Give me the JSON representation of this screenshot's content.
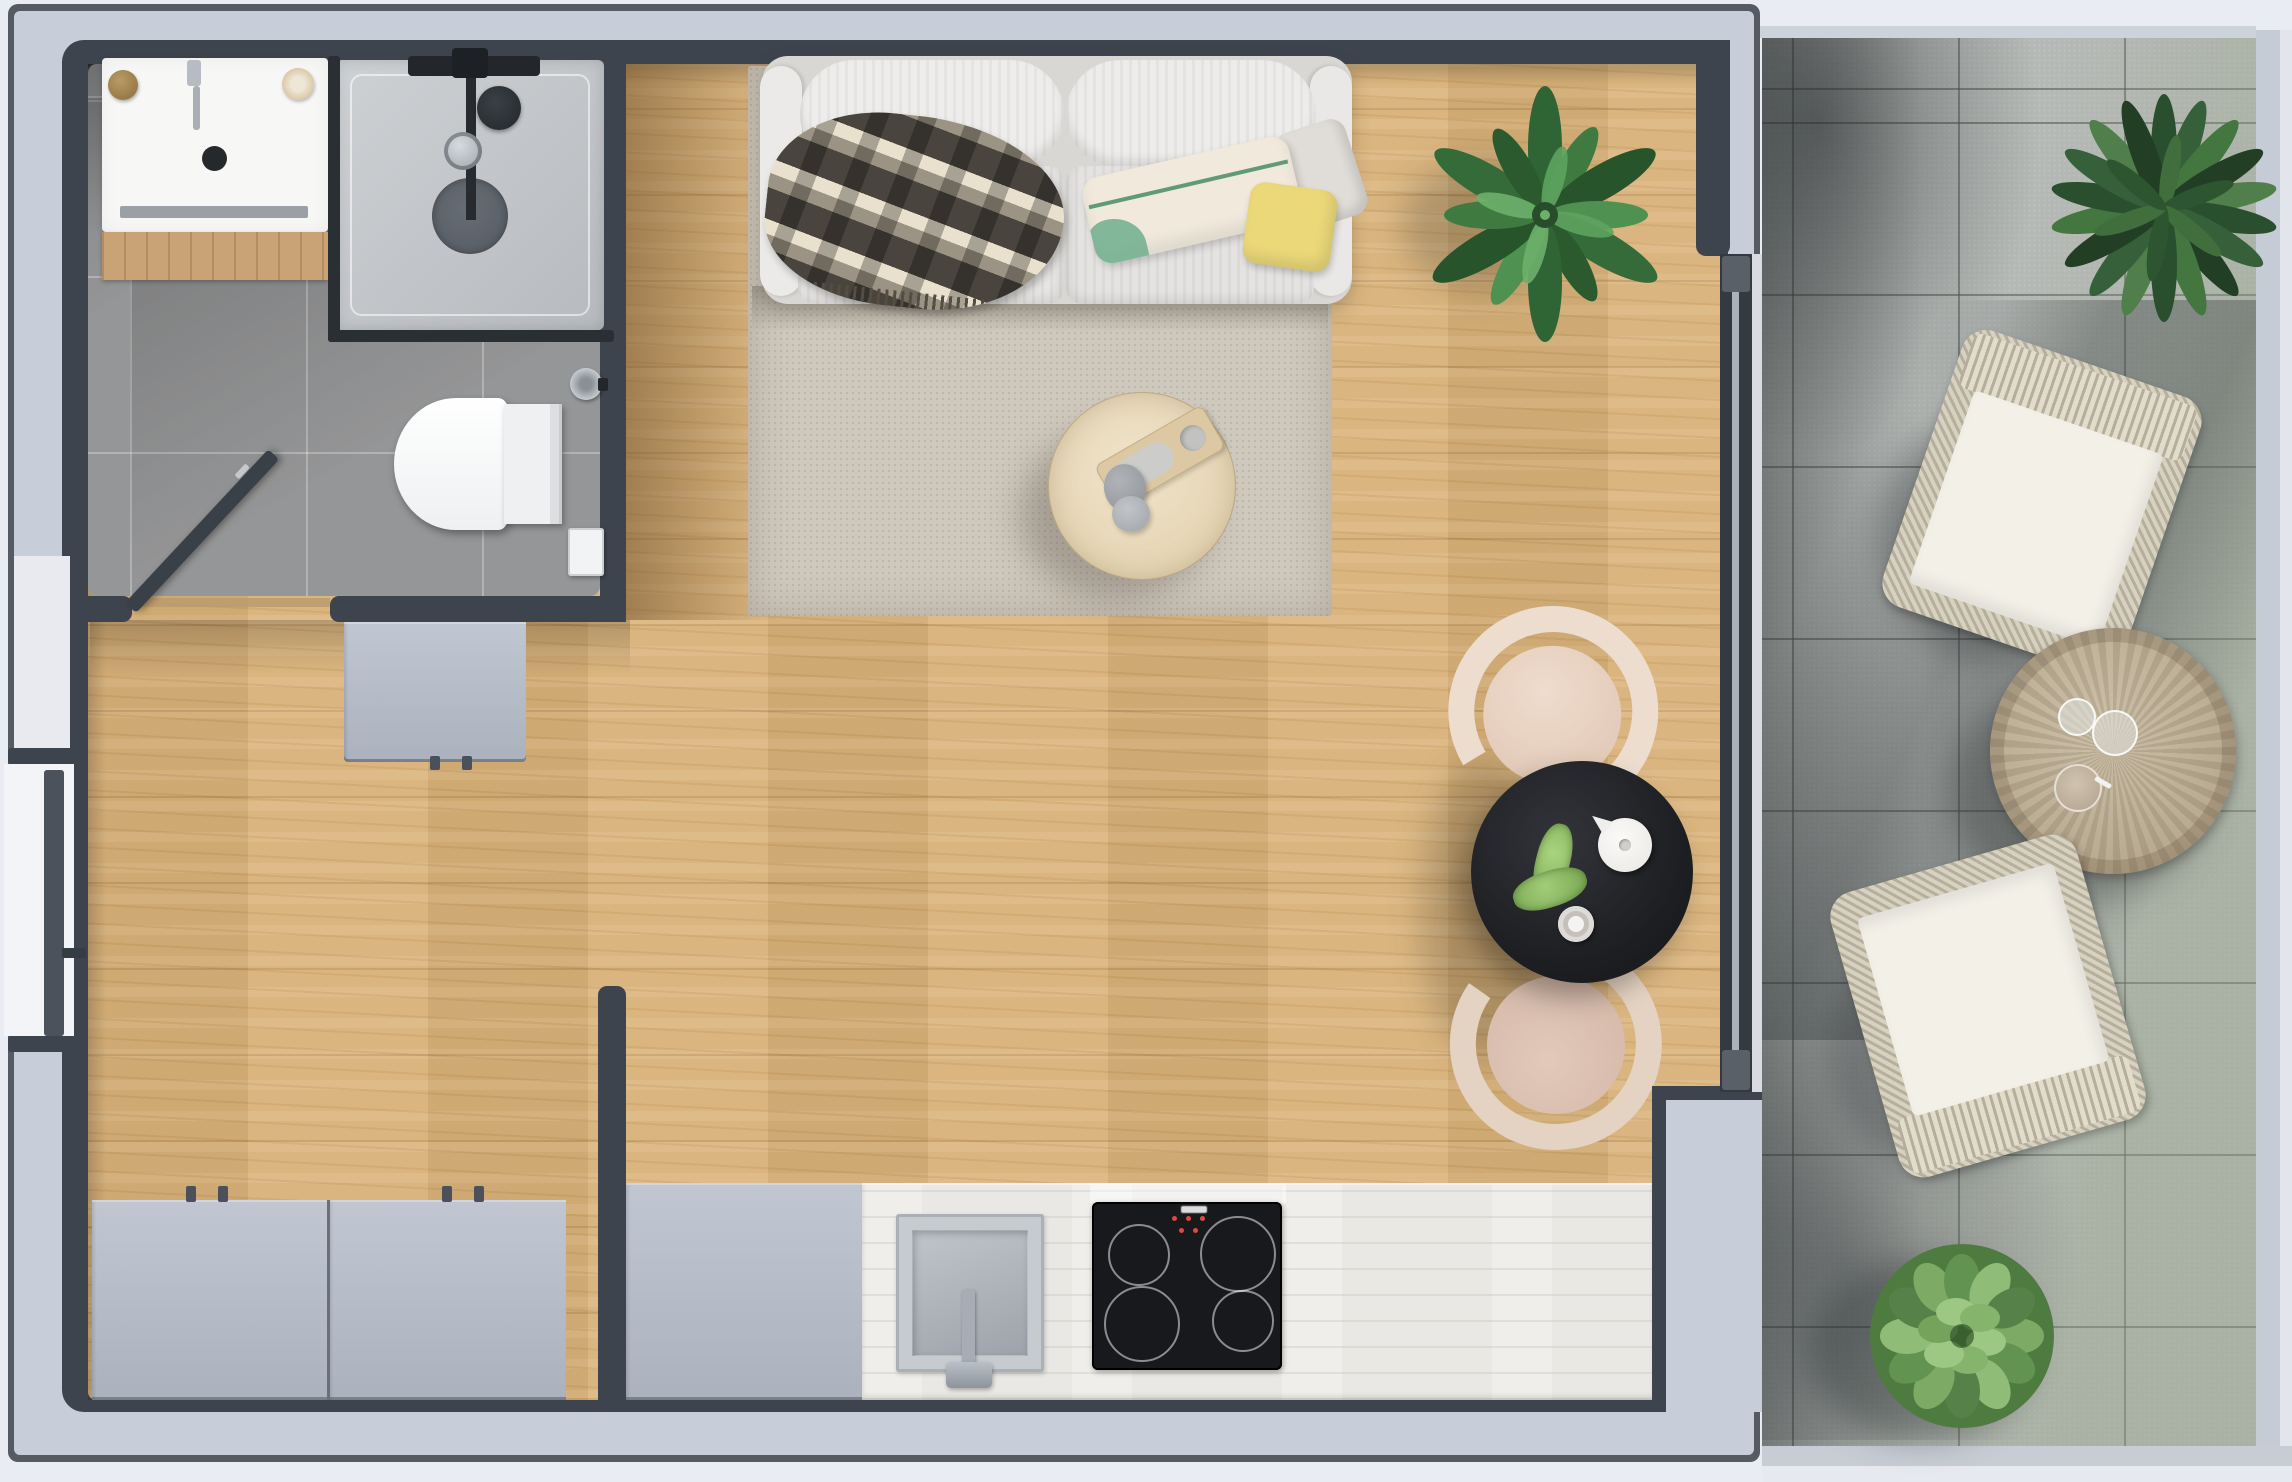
{
  "meta": {
    "kind": "architectural-floor-plan-3d-render",
    "view": "top-down",
    "width_px": 2292,
    "height_px": 1482
  },
  "palette": {
    "outside": "#e9ecf2",
    "wall_outer": "#555a63",
    "wall_light": "#c8ced9",
    "wall_dark": "#3e444d",
    "wood": "#d8b178",
    "bath_tile": "#8e8f90",
    "shower_tray": "#c6c9cd",
    "rug": "#cfc8bc",
    "cabinet": "#b7bdc8",
    "counter": "#eae8e4",
    "cooktop": "#17191d",
    "sofa": "#eceae8",
    "chair_cream": "#ecddcf",
    "table_black": "#202226",
    "balcony_tile": "#b5b9b6",
    "wicker": "#d7d1c0",
    "cushion": "#f3f0e8",
    "plant_dark": "#2f6434",
    "plant_light": "#7dab66",
    "pillow_yellow": "#ead879",
    "mat_wood": "#c9a276",
    "white": "#f7f7f6"
  },
  "rooms": {
    "bathroom": {
      "floor": "grey-stone-tile",
      "items": [
        "washbasin",
        "basin-faucet",
        "soap-dispenser",
        "towel-roll",
        "shelf-bar",
        "wooden-bath-mat",
        "walk-in-shower",
        "shower-fixtures",
        "shower-head",
        "shower-valve",
        "shower-drain",
        "wall-hung-toilet",
        "toilet-brush",
        "toilet-paper-holder",
        "open-bathroom-door"
      ]
    },
    "hallway": {
      "floor": "oak-plank",
      "items": [
        "entrance-door",
        "entrance-door-handle",
        "sideboard-cabinet",
        "wardrobe-left-panel",
        "wardrobe-right-panel"
      ]
    },
    "living_room": {
      "floor": "oak-plank",
      "items": [
        "sofa",
        "sofa-back-cushions",
        "sofa-seat-cushions",
        "plaid-blanket",
        "pillow-cream-green-stripe",
        "pillow-grey",
        "pillow-yellow",
        "area-rug",
        "round-coffee-table",
        "wooden-tray",
        "decor-stones",
        "potted-plant",
        "black-dining-table",
        "dining-chair-north",
        "dining-chair-south",
        "teapot",
        "coffee-cup",
        "green-garnish"
      ]
    },
    "kitchenette": {
      "floor": "oak-plank",
      "items": [
        "tall-cabinet-block",
        "worktop",
        "built-in-sink",
        "sink-faucet",
        "induction-cooktop"
      ]
    },
    "balcony": {
      "floor": "concrete-tile",
      "items": [
        "sliding-glass-door",
        "door-threshold",
        "wicker-chair-north",
        "wicker-chair-south",
        "round-wicker-table",
        "drinking-glass-small",
        "drinking-glass-large",
        "outdoor-cup",
        "conifer-planter",
        "bush-planter"
      ]
    }
  },
  "cooktop": {
    "burners": 4,
    "control_lights": 4,
    "brand_marking": "present-illegible"
  }
}
